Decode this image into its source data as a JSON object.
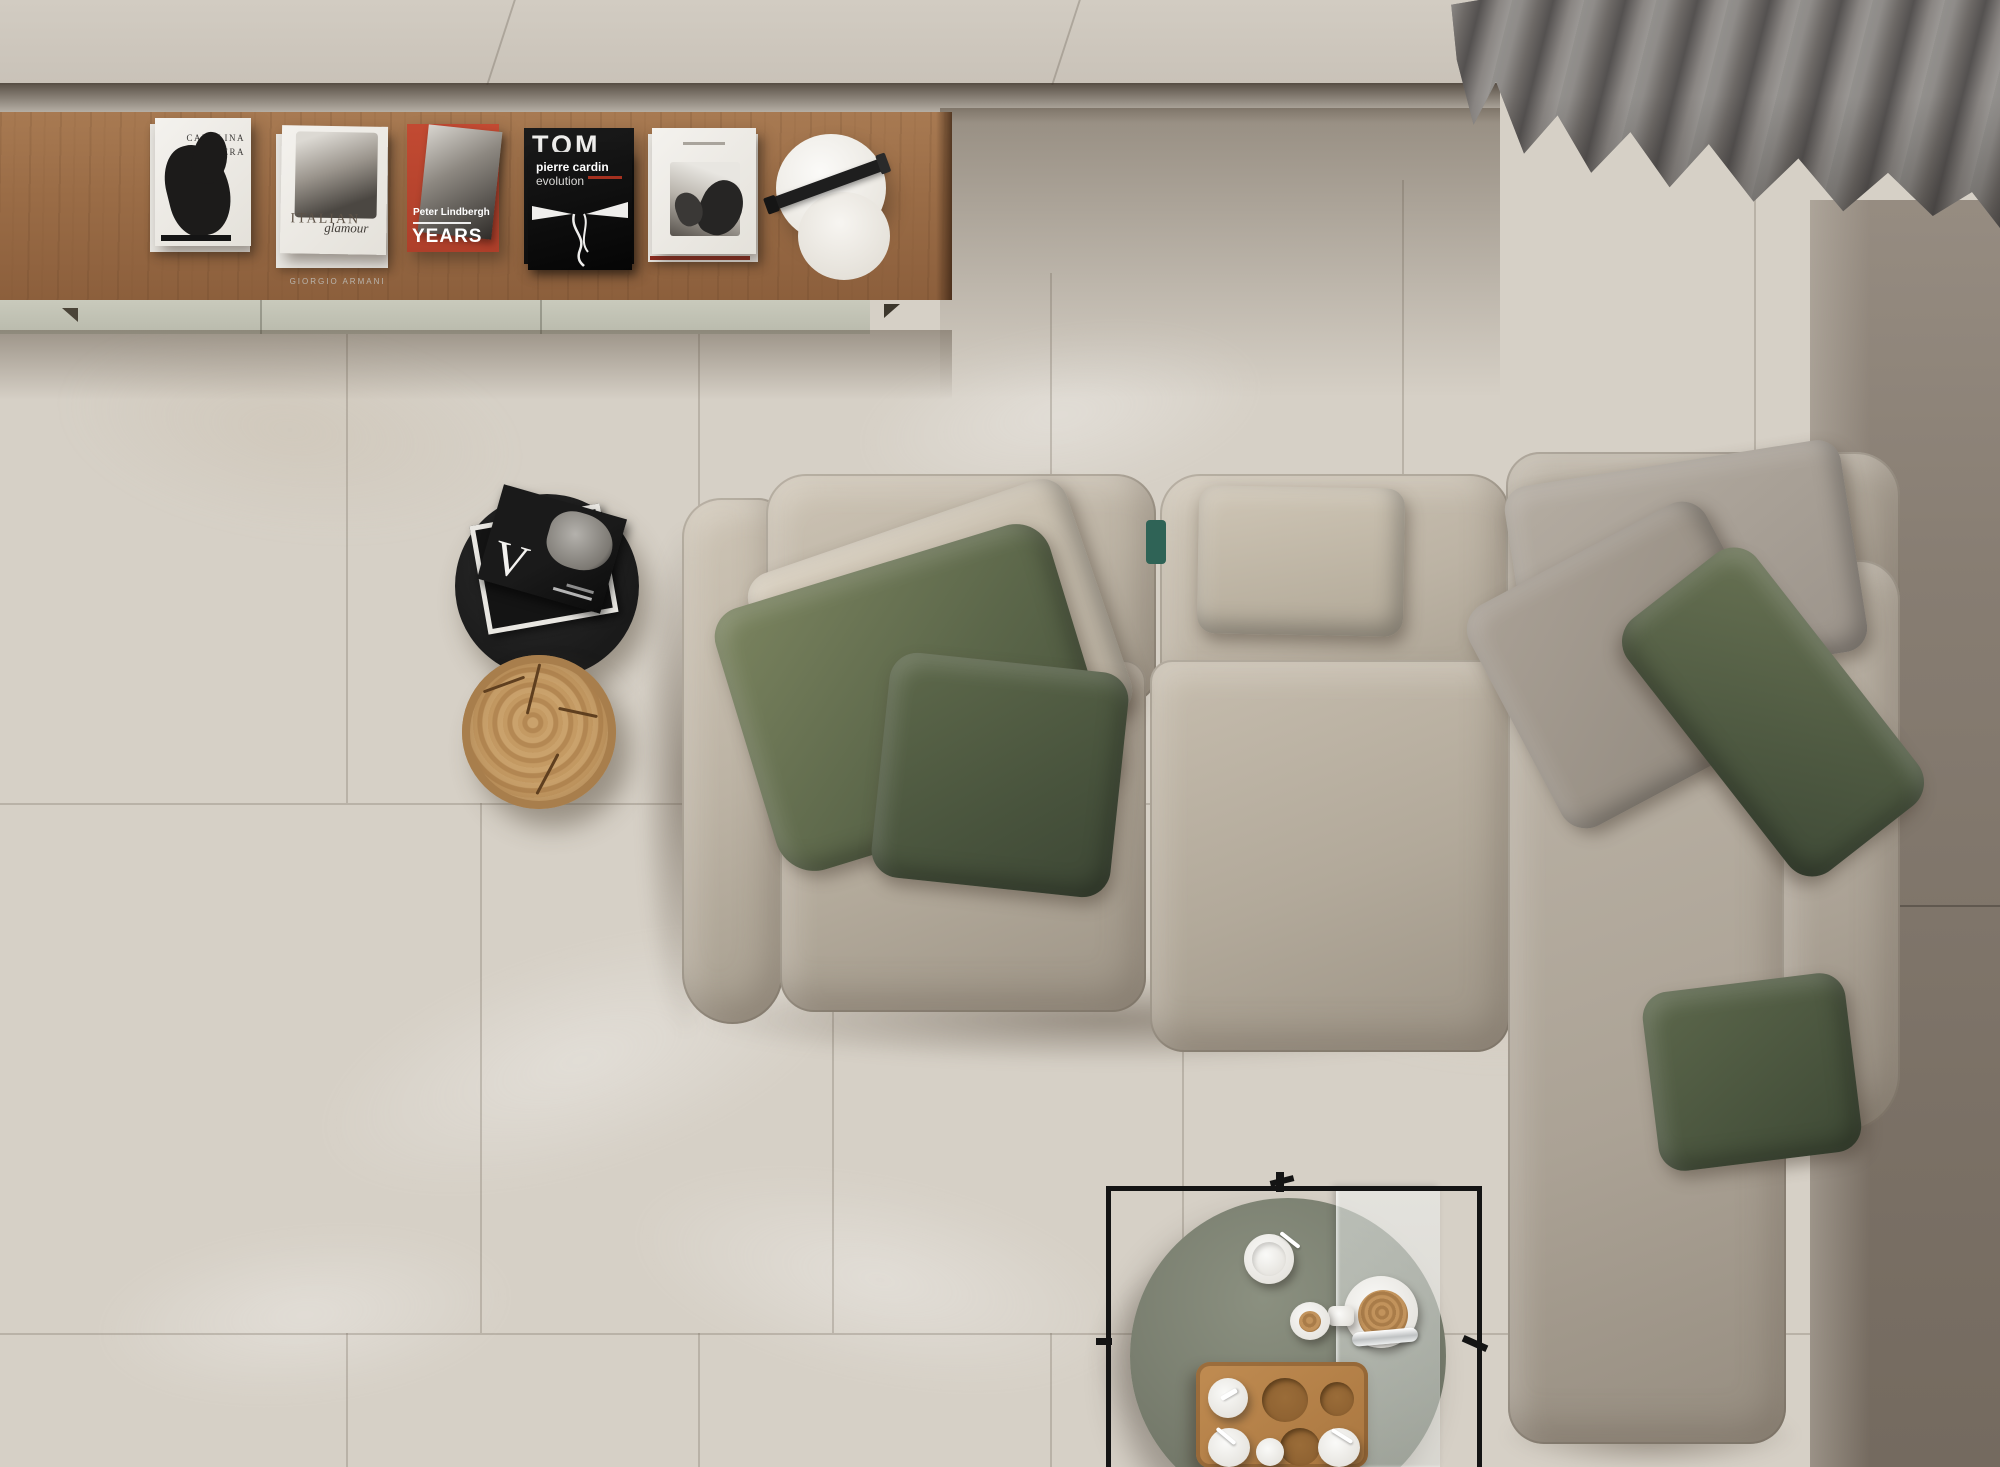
{
  "meta": {
    "scene_type": "top-down interior render",
    "room": "living room"
  },
  "palette": {
    "floor_light": "#d6d0c6",
    "floor_dark": "#7b7166",
    "wall_band": "#cdc6bc",
    "shelf_wood": "#9c6f4b",
    "cabinet": "#c6c7b9",
    "sofa_fabric": "#b9b0a2",
    "pillow_olive": "#57614a",
    "pillow_gray": "#a59d92",
    "curtain_gray": "#716e6b",
    "side_table_black": "#1f1f1f",
    "log_wood": "#c0985f",
    "coffee_disc": "#7b8070",
    "tray_wood": "#b9854d",
    "table_frame": "#141414",
    "teal_accent": "#2f6356"
  },
  "shelf": {
    "books": [
      {
        "title_line1": "CAROLINA",
        "title_line2": "HERRERA"
      },
      {
        "title": "ITALIAN",
        "subtitle": "glamour",
        "under_label": "GIORGIO ARMANI"
      },
      {
        "author": "Peter Lindbergh",
        "big_word": "YEARS"
      },
      {
        "top_bold": "pierre cardin",
        "top_light": "evolution",
        "under_title": "TOM"
      },
      {
        "note": ""
      }
    ]
  },
  "side_table": {
    "magazine_letter": "V"
  }
}
